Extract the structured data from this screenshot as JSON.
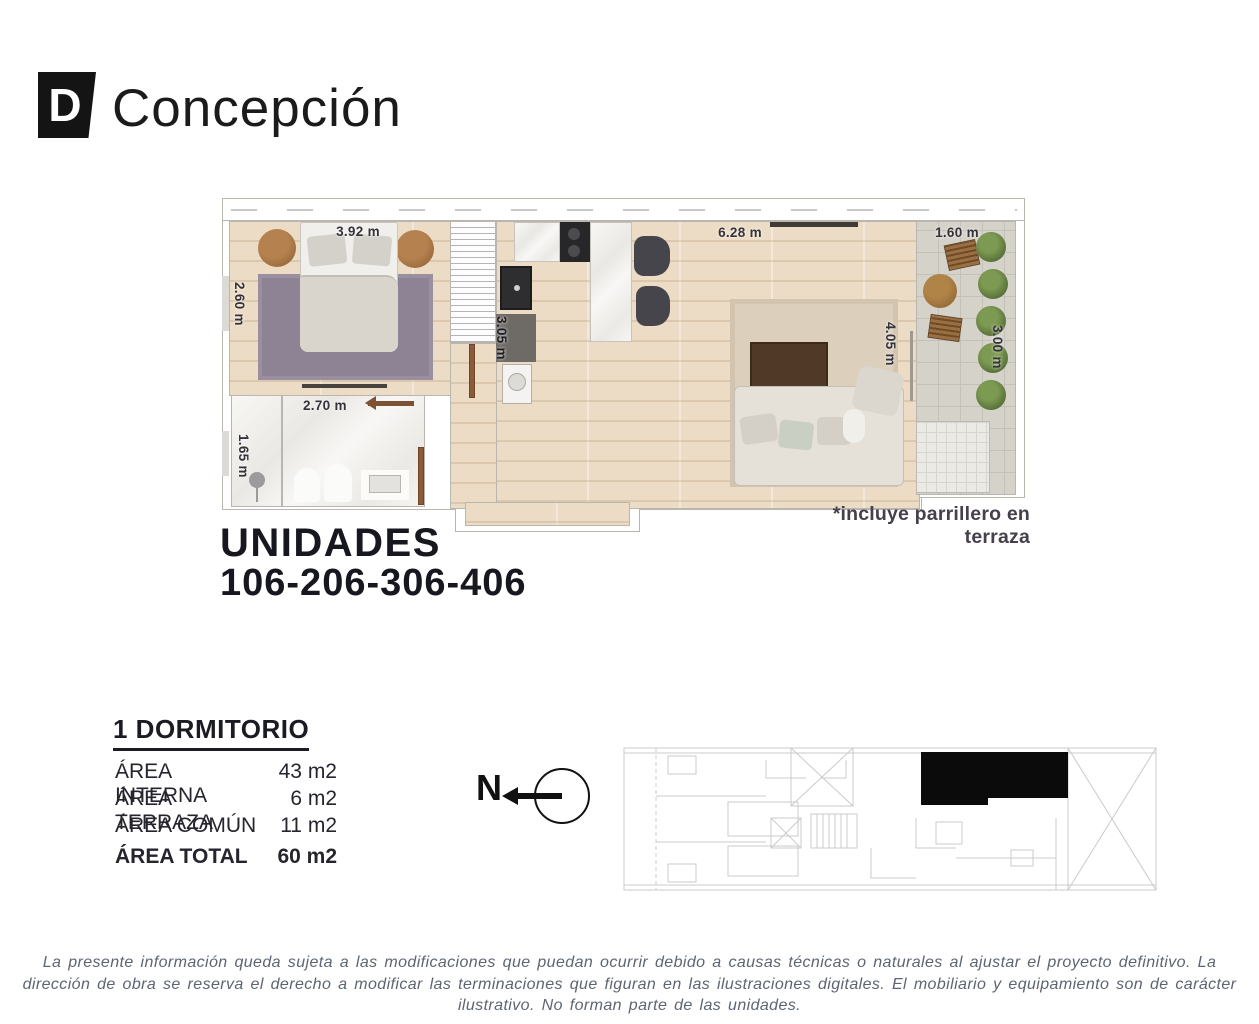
{
  "brand": {
    "logo_letter": "D",
    "name": "Concepción"
  },
  "plan": {
    "dimensions": {
      "bedroom_width": "3.92 m",
      "bedroom_depth": "2.60 m",
      "bathroom_width": "2.70 m",
      "bathroom_depth": "1.65 m",
      "kitchen_depth": "3.05 m",
      "living_width": "6.28 m",
      "living_depth": "4.05 m",
      "terrace_width": "1.60 m",
      "terrace_depth": "3.00 m"
    },
    "note": "*incluye parrillero en terraza"
  },
  "units": {
    "title": "UNIDADES",
    "numbers": "106-206-306-406"
  },
  "details": {
    "type": "1 DORMITORIO",
    "areas": [
      {
        "label": "ÁREA INTERNA",
        "value": "43 m2"
      },
      {
        "label": "ÁREA TERRAZA",
        "value": "6 m2"
      },
      {
        "label": "ÁREA COMÚN",
        "value": "11 m2"
      }
    ],
    "total": {
      "label": "ÁREA TOTAL",
      "value": "60 m2"
    }
  },
  "compass": {
    "north_label": "N"
  },
  "footer": {
    "disclaimer": "La presente información queda sujeta a las modificaciones que puedan ocurrir debido a causas técnicas o naturales al ajustar el proyecto definitivo. La dirección de obra se reserva el derecho a modificar las terminaciones que figuran en las ilustraciones digitales. El mobiliario y equipamiento son de carácter ilustrativo. No forman parte de las unidades."
  },
  "colors": {
    "ink": "#17171f",
    "muted": "#5d6573",
    "unit_marker": "#0b0b0b"
  }
}
